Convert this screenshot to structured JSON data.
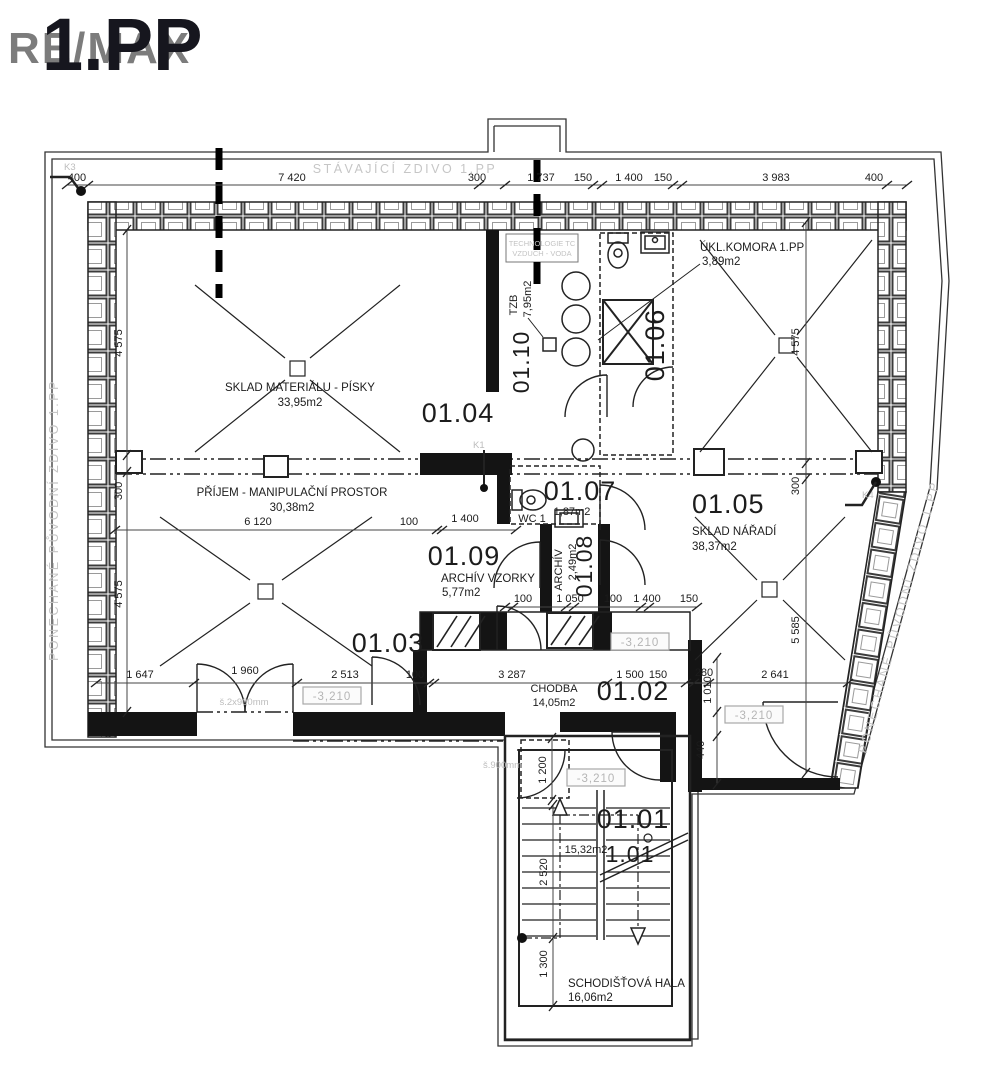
{
  "page": {
    "watermark": "RE/MAX",
    "title": "1.PP"
  },
  "notes": {
    "existing_wall": "STÁVAJÍCÍ ZDIVO 1.PP",
    "kept_wall_left": "PONECHANÉ PŮVODNÍ ZDIVO 1.PP",
    "kept_wall_right": "PONECHANÉ PŮVODNÍ ZDIVO 1.PP",
    "tech_line1": "TECHNOLOGIE TC",
    "tech_line2": "VZDUCH - VODA",
    "door_width_double": "š.2x900mm",
    "door_width_single": "š.900mm",
    "k1": "K1",
    "k3": "K3",
    "k4": "K4",
    "level": "-3,210"
  },
  "rooms": {
    "r0101": {
      "number": "01.01",
      "name": "SCHODIŠŤOVÁ HALA",
      "area": "16,06m2",
      "stair_area": "15,32m2",
      "stair_number": "1.01"
    },
    "r0102": {
      "number": "01.02",
      "name": "CHODBA",
      "area": "14,05m2"
    },
    "r0103": {
      "number": "01.03",
      "name": "PŘÍJEM - MANIPULAČNÍ PROSTOR",
      "area": "30,38m2"
    },
    "r0104": {
      "number": "01.04",
      "name": "SKLAD MATERIÁLU - PÍSKY",
      "area": "33,95m2"
    },
    "r0105": {
      "number": "01.05",
      "name": "SKLAD NÁŘADÍ",
      "area": "38,37m2"
    },
    "r0106": {
      "number": "01.06",
      "name": "ÚKL.KOMORA 1.PP",
      "area": "3,89m2"
    },
    "r0107": {
      "number": "01.07",
      "name": "WC 1",
      "area": "1,87m2"
    },
    "r0108": {
      "number": "01.08",
      "name": "ARCHÍV",
      "area": "2,49m2"
    },
    "r0109": {
      "number": "01.09",
      "name": "ARCHÍV VZORKY",
      "area": "5,77m2"
    },
    "r0110": {
      "number": "01.10",
      "name": "TZB",
      "area": "7,95m2"
    }
  },
  "dims": {
    "top": [
      "400",
      "7 420",
      "300",
      "1 737",
      "150",
      "1 400",
      "150",
      "3 983",
      "400"
    ],
    "left": [
      "4 575",
      "300",
      "4 575"
    ],
    "midleft": [
      "6 120",
      "100",
      "1 400"
    ],
    "mid": [
      "100",
      "1 050",
      "100",
      "1 400",
      "150"
    ],
    "bottom": [
      "1 647",
      "1 960",
      "2 513",
      "100",
      "3 287",
      "1 500",
      "150",
      "280",
      "2 641"
    ],
    "right": [
      "4 575",
      "300",
      "5 585"
    ],
    "vert": [
      "1 010",
      "440",
      "1 200",
      "2 520",
      "1 300"
    ]
  }
}
